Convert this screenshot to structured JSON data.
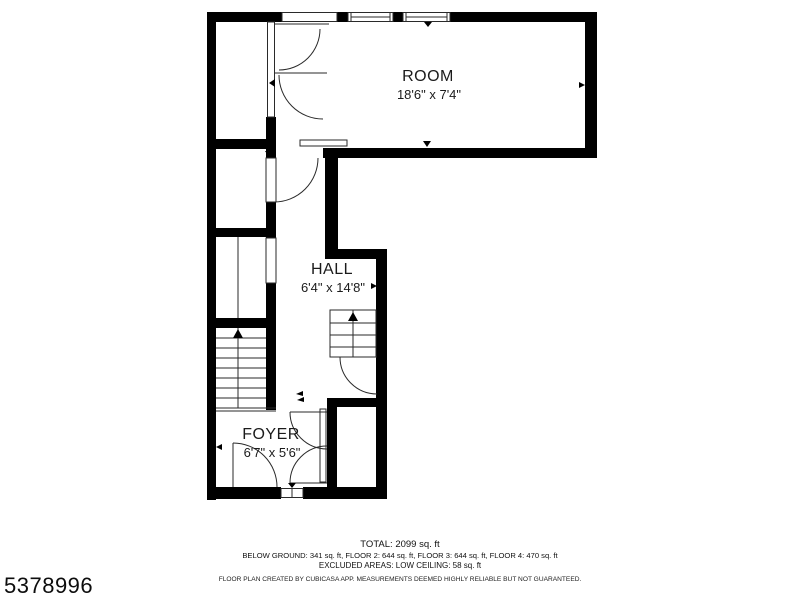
{
  "plan": {
    "rooms": [
      {
        "name": "ROOM",
        "dimensions": "18'6\" x 7'4\""
      },
      {
        "name": "HALL",
        "dimensions": "6'4\" x 14'8\""
      },
      {
        "name": "FOYER",
        "dimensions": "6'7\" x 5'6\""
      }
    ]
  },
  "summary": {
    "total": "TOTAL: 2099 sq. ft",
    "floors": "BELOW GROUND: 341 sq. ft, FLOOR 2: 644 sq. ft, FLOOR 3: 644 sq. ft, FLOOR 4: 470 sq. ft",
    "excluded": "EXCLUDED AREAS: LOW CEILING: 58 sq. ft",
    "disclaimer": "FLOOR PLAN CREATED BY CUBICASA APP. MEASUREMENTS DEEMED HIGHLY RELIABLE BUT NOT GUARANTEED."
  },
  "watermark": "5378996",
  "colors": {
    "wall": "#000000",
    "line": "#2a2a2a",
    "text": "#1b1b1b",
    "background": "#ffffff"
  }
}
